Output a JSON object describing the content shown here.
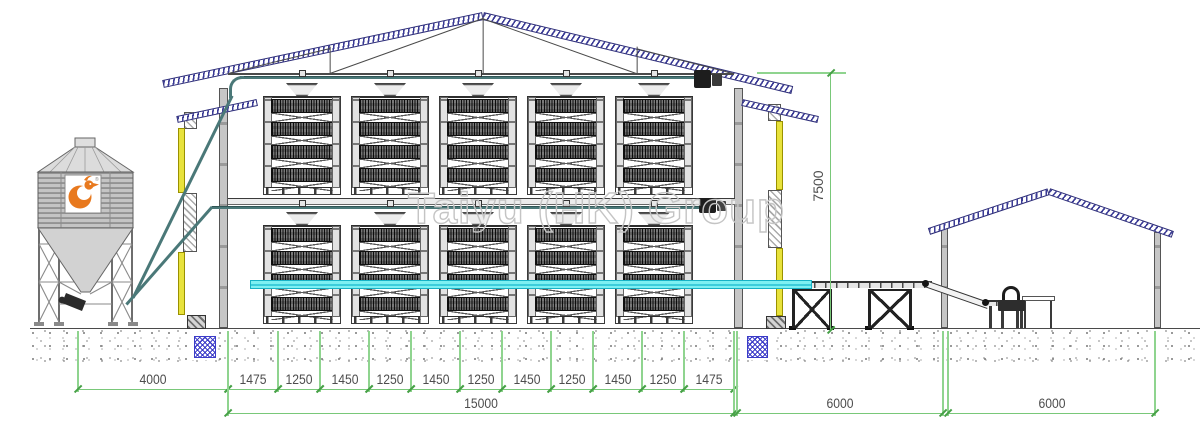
{
  "watermark": "Taiyu (HK) Group",
  "dimensions": {
    "row1": [
      {
        "label": "4000",
        "x": 78,
        "w": 150
      },
      {
        "label": "1475",
        "x": 228,
        "w": 50
      },
      {
        "label": "1250",
        "x": 278,
        "w": 42
      },
      {
        "label": "1450",
        "x": 320,
        "w": 49
      },
      {
        "label": "1250",
        "x": 369,
        "w": 42
      },
      {
        "label": "1450",
        "x": 411,
        "w": 49
      },
      {
        "label": "1250",
        "x": 460,
        "w": 42
      },
      {
        "label": "1450",
        "x": 502,
        "w": 49
      },
      {
        "label": "1250",
        "x": 551,
        "w": 42
      },
      {
        "label": "1450",
        "x": 593,
        "w": 49
      },
      {
        "label": "1250",
        "x": 642,
        "w": 42
      },
      {
        "label": "1475",
        "x": 684,
        "w": 50
      }
    ],
    "row2": [
      {
        "label": "15000",
        "x": 228,
        "w": 506
      },
      {
        "label": "6000",
        "x": 737,
        "w": 206
      },
      {
        "label": "6000",
        "x": 948,
        "w": 207
      }
    ],
    "height": {
      "label": "7500"
    }
  },
  "icons": {
    "silo_logo": "taiyu-rooster-logo",
    "logo_registered_mark": "®"
  },
  "colors": {
    "roof_hatch": "#3a3a96",
    "dimension_green": "#79c879",
    "conveyor_cyan": "#7df0f2",
    "wall_yellow": "#e8e23c",
    "feed_pipe_teal": "#4a7878",
    "logo_orange": "#e8791e",
    "foundation_blue": "#3c3cc8"
  }
}
